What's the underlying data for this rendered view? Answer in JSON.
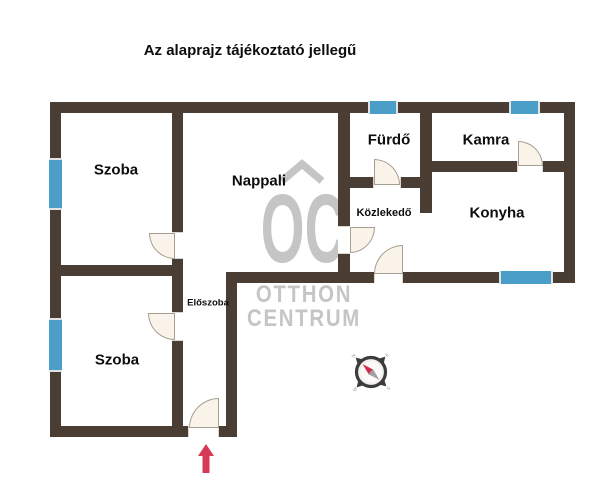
{
  "title": "Az alaprajz tájékoztató jellegű",
  "rooms": {
    "szoba_top": {
      "label": "Szoba"
    },
    "nappali": {
      "label": "Nappali"
    },
    "furdo": {
      "label": "Fürdő"
    },
    "kamra": {
      "label": "Kamra"
    },
    "kozlekedo": {
      "label": "Közlekedő"
    },
    "konyha": {
      "label": "Konyha"
    },
    "eloszoba": {
      "label": "Előszoba"
    },
    "szoba_bottom": {
      "label": "Szoba"
    }
  },
  "watermark": {
    "initials": "OC",
    "line1": "OTTHON",
    "line2": "CENTRUM"
  },
  "compass": {
    "n": "N",
    "e": "E",
    "s": "S",
    "w": "W"
  },
  "theme": {
    "wall_color": "#4a3e34",
    "window_color": "#4a9ec7",
    "door_fill": "#faf3e9",
    "door_stroke": "#a79e93",
    "watermark_gray": "#c5c5c5",
    "arrow_red": "#d63a57",
    "text_color": "#0d0d0d"
  }
}
